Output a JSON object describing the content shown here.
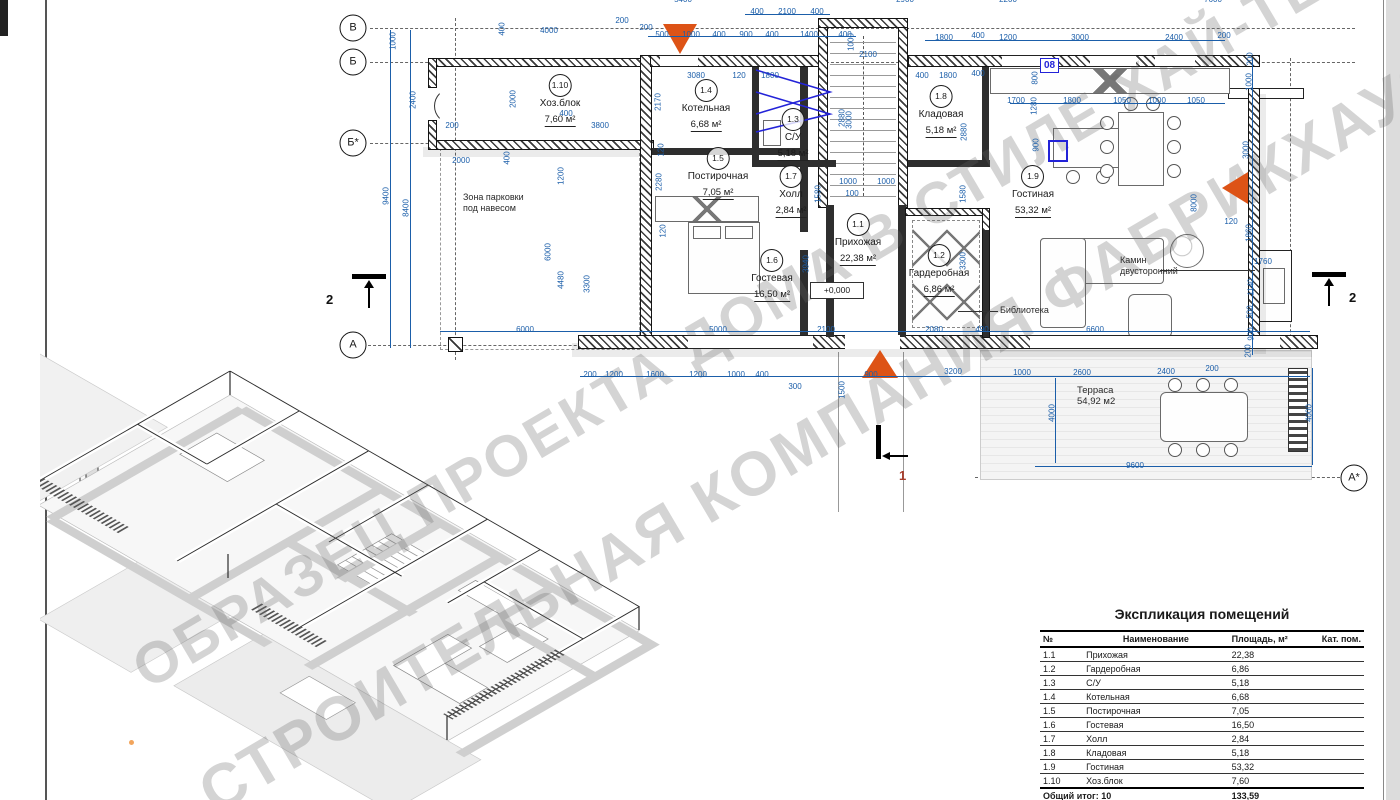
{
  "watermark": {
    "line1": "ОБРАЗЕЦ ПРОЕКТА ДОМА В СТИЛЕ ХАЙ-ТЕК",
    "line2": "СТРОИТЕЛЬНАЯ КОМПАНИЯ ФАБРИКХАУЗ"
  },
  "plan": {
    "grid": [
      {
        "t": "В",
        "s": "left:353px;top:28px"
      },
      {
        "t": "Б",
        "s": "left:353px;top:62px"
      },
      {
        "t": "Б*",
        "s": "left:353px;top:143px"
      },
      {
        "t": "А",
        "s": "left:353px;top:345px"
      },
      {
        "t": "А*",
        "s": "left:1354px;top:478px"
      }
    ],
    "sections": [
      {
        "t": "2",
        "s": "left:326px;top:292px;color:#111"
      },
      {
        "t": "2",
        "s": "left:1349px;top:290px;color:#111"
      },
      {
        "t": "1",
        "s": "left:899px;top:468px;color:#a63b2a"
      }
    ],
    "rooms": [
      {
        "id": "1.10",
        "name": "Хоз.блок",
        "area": "7,60 м²",
        "s": "left:560px;top:74px"
      },
      {
        "id": "1.4",
        "name": "Котельная",
        "area": "6,68 м²",
        "s": "left:706px;top:79px"
      },
      {
        "id": "1.3",
        "name": "С/У",
        "area": "5,18 м²",
        "s": "left:793px;top:108px"
      },
      {
        "id": "1.5",
        "name": "Постирочная",
        "area": "7,05 м²",
        "s": "left:718px;top:147px"
      },
      {
        "id": "1.7",
        "name": "Холл",
        "area": "2,84 м²",
        "s": "left:791px;top:165px"
      },
      {
        "id": "1.1",
        "name": "Прихожая",
        "area": "22,38 м²",
        "s": "left:858px;top:213px"
      },
      {
        "id": "1.6",
        "name": "Гостевая",
        "area": "16,50 м²",
        "s": "left:772px;top:249px"
      },
      {
        "id": "1.2",
        "name": "Гардеробная",
        "area": "6,86 м²",
        "s": "left:939px;top:244px"
      },
      {
        "id": "1.8",
        "name": "Кладовая",
        "area": "5,18 м²",
        "s": "left:941px;top:85px"
      },
      {
        "id": "1.9",
        "name": "Гостиная",
        "area": "53,32 м²",
        "s": "left:1033px;top:165px"
      }
    ],
    "texts": {
      "parking": "Зона парковки\nпод навесом",
      "library": "Библиотека",
      "fireplace": "Камин\nдвусторонний",
      "terrace": "Терраса\n54,92 м2",
      "level": "+0,000",
      "tag08": "08"
    },
    "dims": [
      {
        "t": "5400",
        "s": "left:683px;top:-5px"
      },
      {
        "t": "2900",
        "s": "left:905px;top:-5px"
      },
      {
        "t": "2200",
        "s": "left:1008px;top:-5px"
      },
      {
        "t": "7600",
        "s": "left:1213px;top:-5px"
      },
      {
        "t": "400",
        "s": "left:757px;top:7px"
      },
      {
        "t": "2100",
        "s": "left:787px;top:7px"
      },
      {
        "t": "400",
        "s": "left:817px;top:7px"
      },
      {
        "t": "4000",
        "s": "left:549px;top:26px"
      },
      {
        "t": "200",
        "s": "left:622px;top:16px"
      },
      {
        "t": "200",
        "s": "left:646px;top:23px"
      },
      {
        "t": "500",
        "s": "left:662px;top:30px"
      },
      {
        "t": "1000",
        "s": "left:691px;top:30px"
      },
      {
        "t": "400",
        "s": "left:719px;top:30px"
      },
      {
        "t": "900",
        "s": "left:746px;top:30px"
      },
      {
        "t": "400",
        "s": "left:772px;top:30px"
      },
      {
        "t": "1400",
        "s": "left:809px;top:30px"
      },
      {
        "t": "400",
        "s": "left:845px;top:30px"
      },
      {
        "t": "1800",
        "s": "left:944px;top:33px"
      },
      {
        "t": "400",
        "s": "left:978px;top:31px"
      },
      {
        "t": "1200",
        "s": "left:1008px;top:33px"
      },
      {
        "t": "3000",
        "s": "left:1080px;top:33px"
      },
      {
        "t": "2400",
        "s": "left:1174px;top:33px"
      },
      {
        "t": "200",
        "s": "left:1224px;top:31px"
      },
      {
        "t": "400",
        "s": "left:922px;top:71px"
      },
      {
        "t": "1800",
        "s": "left:948px;top:71px"
      },
      {
        "t": "400",
        "s": "left:978px;top:69px"
      },
      {
        "t": "1700",
        "s": "left:1016px;top:96px"
      },
      {
        "t": "1800",
        "s": "left:1072px;top:96px"
      },
      {
        "t": "1050",
        "s": "left:1122px;top:96px"
      },
      {
        "t": "1000",
        "s": "left:1157px;top:96px"
      },
      {
        "t": "1050",
        "s": "left:1196px;top:96px"
      },
      {
        "t": "3080",
        "s": "left:696px;top:71px"
      },
      {
        "t": "120",
        "s": "left:739px;top:71px"
      },
      {
        "t": "1800",
        "s": "left:770px;top:71px"
      },
      {
        "t": "2100",
        "s": "left:868px;top:50px"
      },
      {
        "t": "1000",
        "r": 1,
        "s": "left:851px;top:42px"
      },
      {
        "t": "3000",
        "r": 1,
        "s": "left:849px;top:120px"
      },
      {
        "t": "1000",
        "s": "left:848px;top:177px"
      },
      {
        "t": "1000",
        "s": "left:886px;top:177px"
      },
      {
        "t": "100",
        "s": "left:852px;top:189px"
      },
      {
        "t": "1000",
        "r": 1,
        "s": "left:393px;top:41px"
      },
      {
        "t": "2400",
        "r": 1,
        "s": "left:413px;top:100px"
      },
      {
        "t": "9400",
        "r": 1,
        "s": "left:386px;top:196px"
      },
      {
        "t": "8400",
        "r": 1,
        "s": "left:406px;top:208px"
      },
      {
        "t": "400",
        "r": 1,
        "s": "left:502px;top:29px"
      },
      {
        "t": "2000",
        "r": 1,
        "s": "left:513px;top:99px"
      },
      {
        "t": "2000",
        "s": "left:461px;top:156px"
      },
      {
        "t": "200",
        "s": "left:452px;top:121px"
      },
      {
        "t": "400",
        "r": 1,
        "s": "left:507px;top:158px"
      },
      {
        "t": "400",
        "s": "left:566px;top:109px"
      },
      {
        "t": "3800",
        "s": "left:600px;top:121px"
      },
      {
        "t": "2170",
        "r": 1,
        "s": "left:658px;top:102px"
      },
      {
        "t": "120",
        "r": 1,
        "s": "left:661px;top:150px"
      },
      {
        "t": "1200",
        "r": 1,
        "s": "left:561px;top:176px"
      },
      {
        "t": "2280",
        "r": 1,
        "s": "left:659px;top:182px"
      },
      {
        "t": "6000",
        "r": 1,
        "s": "left:548px;top:252px"
      },
      {
        "t": "4480",
        "r": 1,
        "s": "left:561px;top:280px"
      },
      {
        "t": "3300",
        "r": 1,
        "s": "left:587px;top:284px"
      },
      {
        "t": "120",
        "r": 1,
        "s": "left:663px;top:231px"
      },
      {
        "t": "3940",
        "r": 1,
        "s": "left:806px;top:264px"
      },
      {
        "t": "1580",
        "r": 1,
        "s": "left:818px;top:194px"
      },
      {
        "t": "2880",
        "r": 1,
        "s": "left:842px;top:118px"
      },
      {
        "t": "1580",
        "r": 1,
        "s": "left:963px;top:194px"
      },
      {
        "t": "3300",
        "r": 1,
        "s": "left:963px;top:261px"
      },
      {
        "t": "2880",
        "r": 1,
        "s": "left:964px;top:132px"
      },
      {
        "t": "800",
        "r": 1,
        "s": "left:1035px;top:78px"
      },
      {
        "t": "1280",
        "r": 1,
        "s": "left:1034px;top:106px"
      },
      {
        "t": "900",
        "r": 1,
        "s": "left:1036px;top:145px"
      },
      {
        "t": "8000",
        "r": 1,
        "s": "left:1194px;top:203px"
      },
      {
        "t": "200",
        "r": 1,
        "s": "left:1250px;top:59px"
      },
      {
        "t": "1000",
        "r": 1,
        "s": "left:1249px;top:82px"
      },
      {
        "t": "3000",
        "r": 1,
        "s": "left:1246px;top:150px"
      },
      {
        "t": "120",
        "s": "left:1231px;top:217px"
      },
      {
        "t": "1860",
        "r": 1,
        "s": "left:1249px;top:233px"
      },
      {
        "t": "1760",
        "s": "left:1263px;top:257px"
      },
      {
        "t": "1140",
        "r": 1,
        "s": "left:1251px;top:287px"
      },
      {
        "t": "500",
        "r": 1,
        "s": "left:1250px;top:312px"
      },
      {
        "t": "900",
        "r": 1,
        "s": "left:1251px;top:334px"
      },
      {
        "t": "200",
        "r": 1,
        "s": "left:1248px;top:351px"
      },
      {
        "t": "6000",
        "s": "left:525px;top:325px"
      },
      {
        "t": "5000",
        "s": "left:718px;top:325px"
      },
      {
        "t": "2100",
        "s": "left:826px;top:325px"
      },
      {
        "t": "2080",
        "s": "left:934px;top:325px"
      },
      {
        "t": "490",
        "s": "left:982px;top:325px"
      },
      {
        "t": "6600",
        "s": "left:1095px;top:325px"
      },
      {
        "t": "200",
        "s": "left:590px;top:370px"
      },
      {
        "t": "1200",
        "s": "left:614px;top:370px"
      },
      {
        "t": "1600",
        "s": "left:655px;top:370px"
      },
      {
        "t": "1200",
        "s": "left:698px;top:370px"
      },
      {
        "t": "1000",
        "s": "left:736px;top:370px"
      },
      {
        "t": "400",
        "s": "left:762px;top:370px"
      },
      {
        "t": "900",
        "s": "left:871px;top:370px"
      },
      {
        "t": "300",
        "s": "left:795px;top:382px"
      },
      {
        "t": "1500",
        "r": 1,
        "s": "left:842px;top:390px"
      },
      {
        "t": "3200",
        "s": "left:953px;top:367px"
      },
      {
        "t": "1000",
        "s": "left:1022px;top:368px"
      },
      {
        "t": "2600",
        "s": "left:1082px;top:368px"
      },
      {
        "t": "2400",
        "s": "left:1166px;top:367px"
      },
      {
        "t": "200",
        "s": "left:1212px;top:364px"
      },
      {
        "t": "4000",
        "r": 1,
        "s": "left:1052px;top:413px"
      },
      {
        "t": "9600",
        "s": "left:1135px;top:461px"
      },
      {
        "t": "4000",
        "r": 1,
        "s": "left:1309px;top:413px"
      }
    ]
  },
  "table": {
    "title": "Экспликация помещений",
    "col_no": "№",
    "col_name": "Наименование",
    "col_area": "Площадь, м²",
    "col_cat": "Кат. пом.",
    "rows": [
      {
        "no": "1.1",
        "name": "Прихожая",
        "area": "22,38",
        "cat": ""
      },
      {
        "no": "1.2",
        "name": "Гардеробная",
        "area": "6,86",
        "cat": ""
      },
      {
        "no": "1.3",
        "name": "С/У",
        "area": "5,18",
        "cat": ""
      },
      {
        "no": "1.4",
        "name": "Котельная",
        "area": "6,68",
        "cat": ""
      },
      {
        "no": "1.5",
        "name": "Постирочная",
        "area": "7,05",
        "cat": ""
      },
      {
        "no": "1.6",
        "name": "Гостевая",
        "area": "16,50",
        "cat": ""
      },
      {
        "no": "1.7",
        "name": "Холл",
        "area": "2,84",
        "cat": ""
      },
      {
        "no": "1.8",
        "name": "Кладовая",
        "area": "5,18",
        "cat": ""
      },
      {
        "no": "1.9",
        "name": "Гостиная",
        "area": "53,32",
        "cat": ""
      },
      {
        "no": "1.10",
        "name": "Хоз.блок",
        "area": "7,60",
        "cat": ""
      }
    ],
    "total_label": "Общий итог: 10",
    "total_value": "133,59"
  }
}
